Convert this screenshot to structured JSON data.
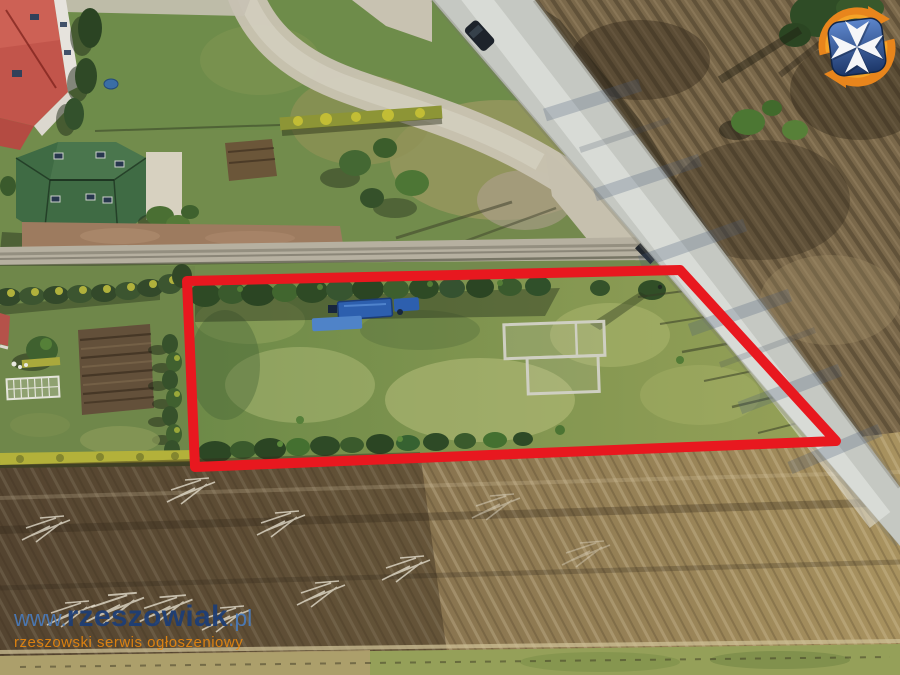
{
  "watermark": {
    "www": "www.",
    "name": "rzeszowiak",
    "tld": ".pl",
    "tagline": "rzeszowski serwis ogłoszeniowy"
  },
  "logo": {
    "icon": "rzeszowiak-shield-logo",
    "shield_color": "#24468c",
    "cross_color": "#f5f6f8",
    "arrows_color": "#e8851c"
  },
  "plot_outline": {
    "points": "187,281 680,270 836,441 195,467",
    "color": "#e8181f",
    "stroke_width": 10
  },
  "scene": {
    "type": "aerial-drone-photo-of-land-plot",
    "features": [
      "red-roof-house",
      "green-roof-house",
      "asphalt-road",
      "gravel-lane",
      "hedgerows",
      "tilled-garden",
      "greenhouse-frame",
      "building-foundations",
      "blue-machinery",
      "tree-row",
      "dry-scrub-field",
      "marked-plot"
    ]
  }
}
